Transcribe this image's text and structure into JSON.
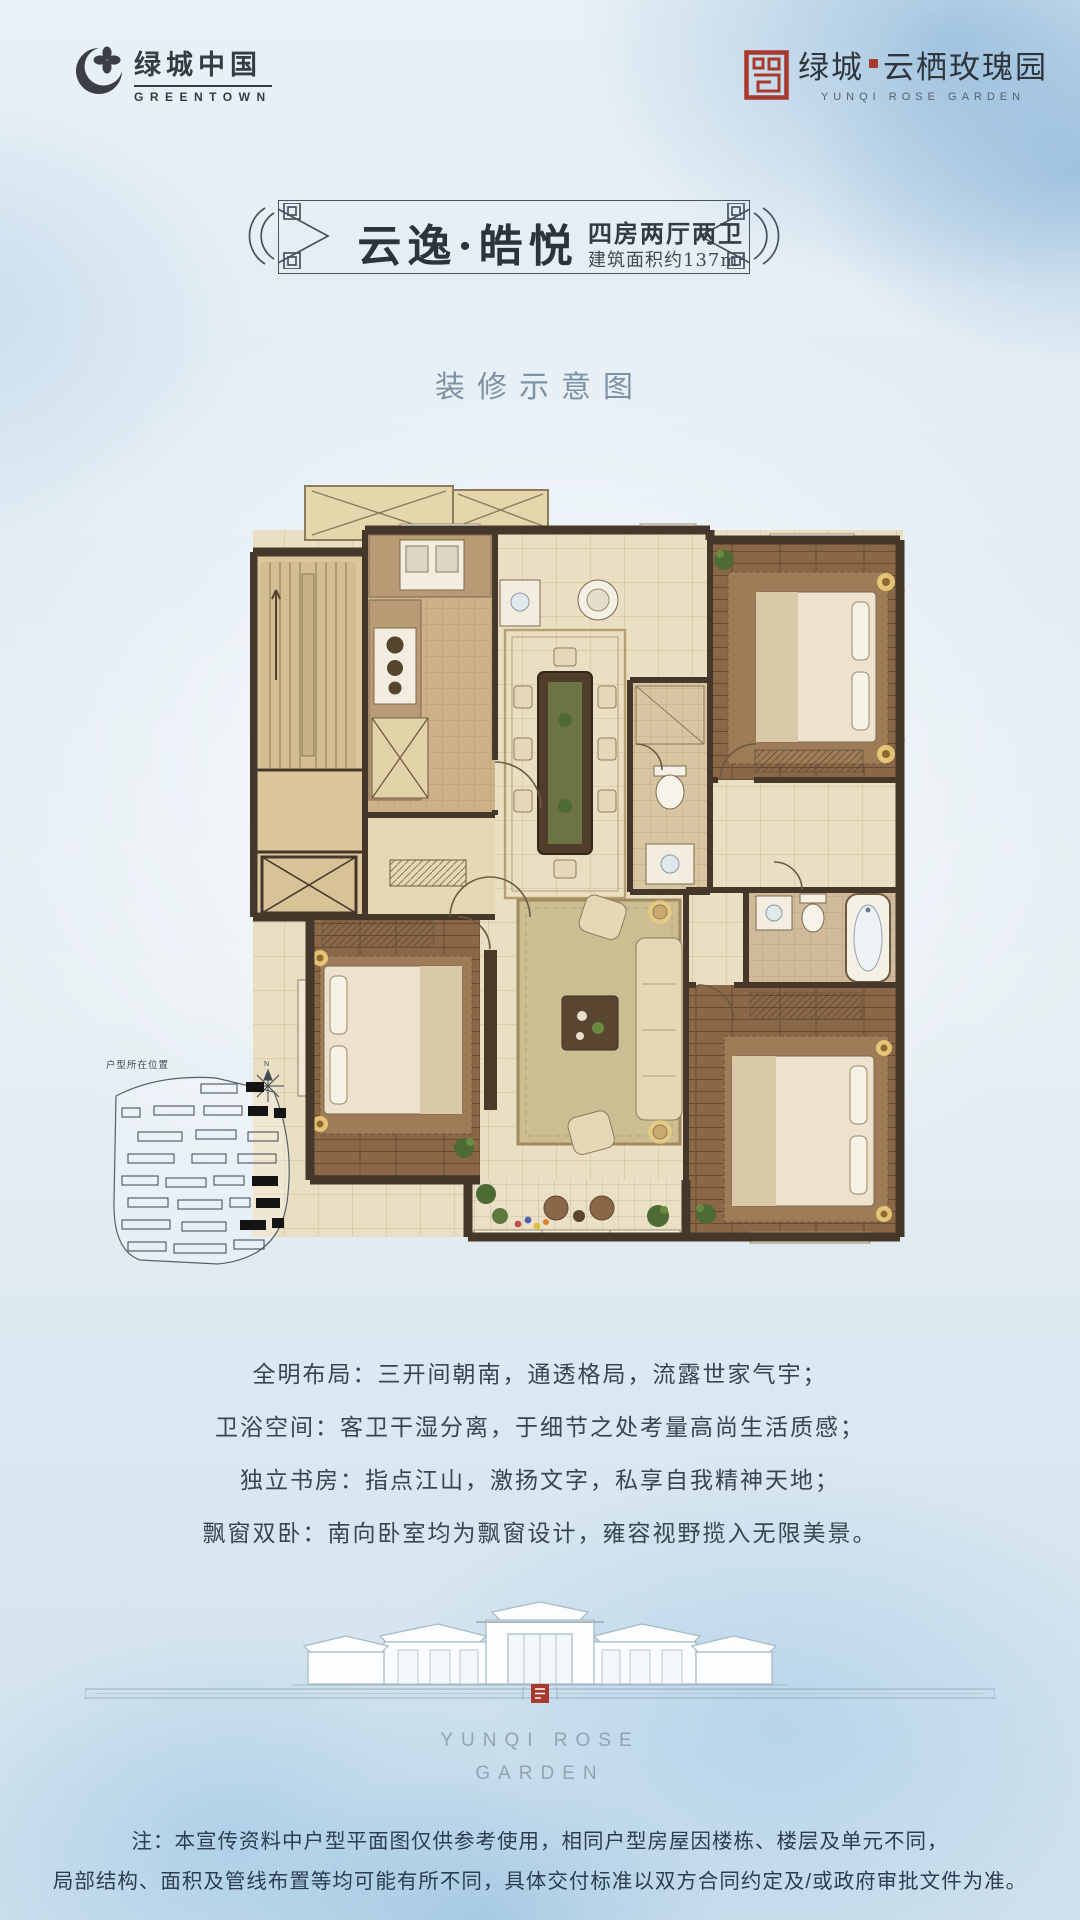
{
  "header": {
    "greentown": {
      "name_cn": "绿城中国",
      "name_en": "GREENTOWN"
    },
    "project": {
      "prefix_cn": "绿城",
      "suffix_cn": "云栖玫瑰园",
      "name_en": "YUNQI ROSE GARDEN"
    }
  },
  "banner": {
    "title": "云逸·皓悦",
    "spec": "四房两厅两卫",
    "area": "建筑面积约137m²"
  },
  "renovation_note": "装修示意图",
  "site_map": {
    "label": "户型所在位置",
    "compass": "N"
  },
  "features": [
    "全明布局：三开间朝南，通透格局，流露世家气宇；",
    "卫浴空间：客卫干湿分离，于细节之处考量高尚生活质感；",
    "独立书房：指点江山，激扬文字，私享自我精神天地；",
    "飘窗双卧：南向卧室均为飘窗设计，雍容视野揽入无限美景。"
  ],
  "brand_footer": {
    "line1": "YUNQI ROSE",
    "line2": "GARDEN"
  },
  "disclaimer": {
    "line1": "注：本宣传资料中户型平面图仅供参考使用，相同户型房屋因楼栋、楼层及单元不同，",
    "line2": "局部结构、面积及管线布置等均可能有所不同，具体交付标准以双方合同约定及/或政府审批文件为准。"
  },
  "colors": {
    "accent_red": "#a8392e",
    "ink": "#363c43",
    "wall": "#45382b",
    "line": "#46525e"
  }
}
